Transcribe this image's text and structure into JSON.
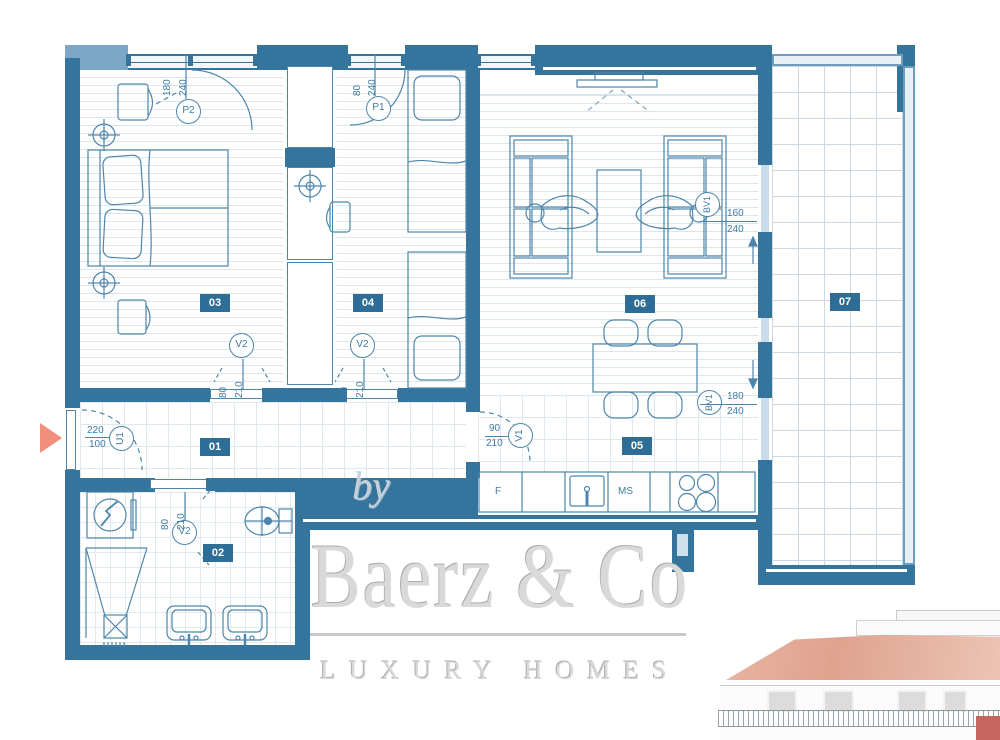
{
  "plan": {
    "rooms": [
      {
        "id": "01",
        "name": "hallway"
      },
      {
        "id": "02",
        "name": "bathroom"
      },
      {
        "id": "03",
        "name": "bedroom"
      },
      {
        "id": "04",
        "name": "bedroom-2"
      },
      {
        "id": "05",
        "name": "kitchen-dining"
      },
      {
        "id": "06",
        "name": "living-room"
      },
      {
        "id": "07",
        "name": "terrace"
      }
    ],
    "openings": {
      "p2": {
        "label": "P2",
        "top": "180",
        "bottom": "240"
      },
      "p1": {
        "label": "P1",
        "top": "80",
        "bottom": "240"
      },
      "v2a": {
        "label": "V2",
        "top": "80",
        "bottom": "210"
      },
      "v2b": {
        "label": "V2",
        "top": "80",
        "bottom": "210"
      },
      "v2c": {
        "label": "V2",
        "top": "80",
        "bottom": "210"
      },
      "v1": {
        "label": "V1",
        "top": "90",
        "bottom": "210"
      },
      "u1": {
        "label": "U1",
        "top": "220",
        "bottom": "100"
      },
      "bv1a": {
        "label": "BV1",
        "top": "160",
        "bottom": "240"
      },
      "bv1b": {
        "label": "BV1",
        "top": "180",
        "bottom": "240"
      }
    },
    "kitchen_labels": {
      "fridge": "F",
      "unit": "MS"
    }
  },
  "watermark": {
    "by": "by",
    "brand": "Baerz & Co",
    "tagline": "LUXURY HOMES"
  },
  "colors": {
    "wall": "#35749c",
    "pier": "#7ba6c5",
    "line_accent": "#4e86ab",
    "label_text": "#3f7ba2",
    "badge_bg": "#2e6d95",
    "entry_arrow": "#ef8f7c",
    "roof": "#dfa28f",
    "building_red": "#c4655f",
    "watermark_gray": "#d9d9d9"
  }
}
